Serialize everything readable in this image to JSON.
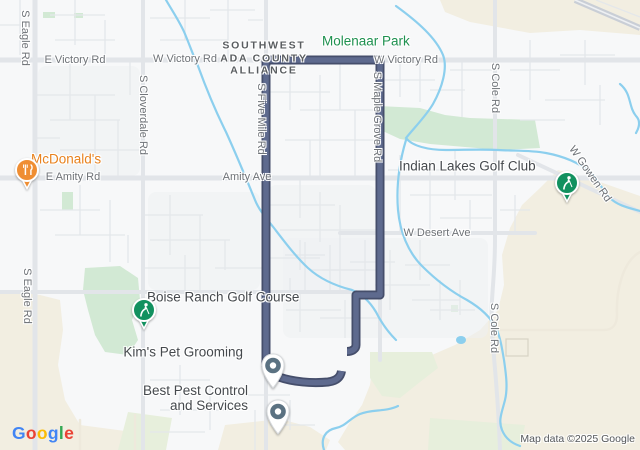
{
  "colors": {
    "land": "#f7f8f9",
    "sand": "#f2eee1",
    "park": "#d2e9d4",
    "palegreen": "#e7efdc",
    "tint": "#eef1f3",
    "water": "#8ccfee",
    "road_minor": "#e4e7ea",
    "road_major": "#e2e5e9",
    "road_hwy": "#c9ced6",
    "tanroad": "#eee9dc",
    "lotline": "#d8d3c4",
    "route_casing": "#454e6b",
    "route_fill": "#5e6a8e",
    "label_road": "#6e7277",
    "label_alliance": "#595d60",
    "label_green": "#1f9150",
    "label_dark": "#45494d",
    "label_mcd": "#e8821e",
    "label_attrib": "#54575b",
    "pin_golf": "#12915f",
    "pin_mcd": "#ef8e33",
    "pin_slate": "#5b7282"
  },
  "road_labels": [
    {
      "text": "E Victory Rd"
    },
    {
      "text": "W Victory Rd"
    },
    {
      "text": "W Victory Rd"
    },
    {
      "text": "S Eagle Rd"
    },
    {
      "text": "S Eagle Rd"
    },
    {
      "text": "S Cloverdale Rd"
    },
    {
      "text": "S Five Mile Rd"
    },
    {
      "text": "S Maple Grove Rd"
    },
    {
      "text": "E Amity Rd"
    },
    {
      "text": "Amity Ave"
    },
    {
      "text": "W Desert Ave"
    },
    {
      "text": "S Cole Rd"
    },
    {
      "text": "S Cole Rd"
    },
    {
      "text": "W Gowen Rd"
    }
  ],
  "areas": {
    "molenaar": "Molenaar Park",
    "alliance": {
      "line1": "SOUTHWEST",
      "line2": "ADA COUNTY",
      "line3": "ALLIANCE"
    }
  },
  "places": {
    "mcdonalds": {
      "name": "McDonald's",
      "icon": "fork-knife-icon"
    },
    "indian_lakes": {
      "name": "Indian Lakes Golf Club",
      "icon": "golfer-icon"
    },
    "boise_ranch": {
      "name": "Boise Ranch Golf Course",
      "icon": "golfer-icon"
    },
    "kims": {
      "name": "Kim's Pet Grooming",
      "icon": "place-pin-icon"
    },
    "best_pest": {
      "line1": "Best Pest Control",
      "line2": "and Services",
      "icon": "place-pin-icon"
    }
  },
  "footer": {
    "attribution": "Map data ©2025 Google",
    "logo_letters": [
      {
        "ch": "G",
        "color": "#4285F4"
      },
      {
        "ch": "o",
        "color": "#EA4335"
      },
      {
        "ch": "o",
        "color": "#FBBC05"
      },
      {
        "ch": "g",
        "color": "#4285F4"
      },
      {
        "ch": "l",
        "color": "#34A853"
      },
      {
        "ch": "e",
        "color": "#EA4335"
      }
    ]
  }
}
